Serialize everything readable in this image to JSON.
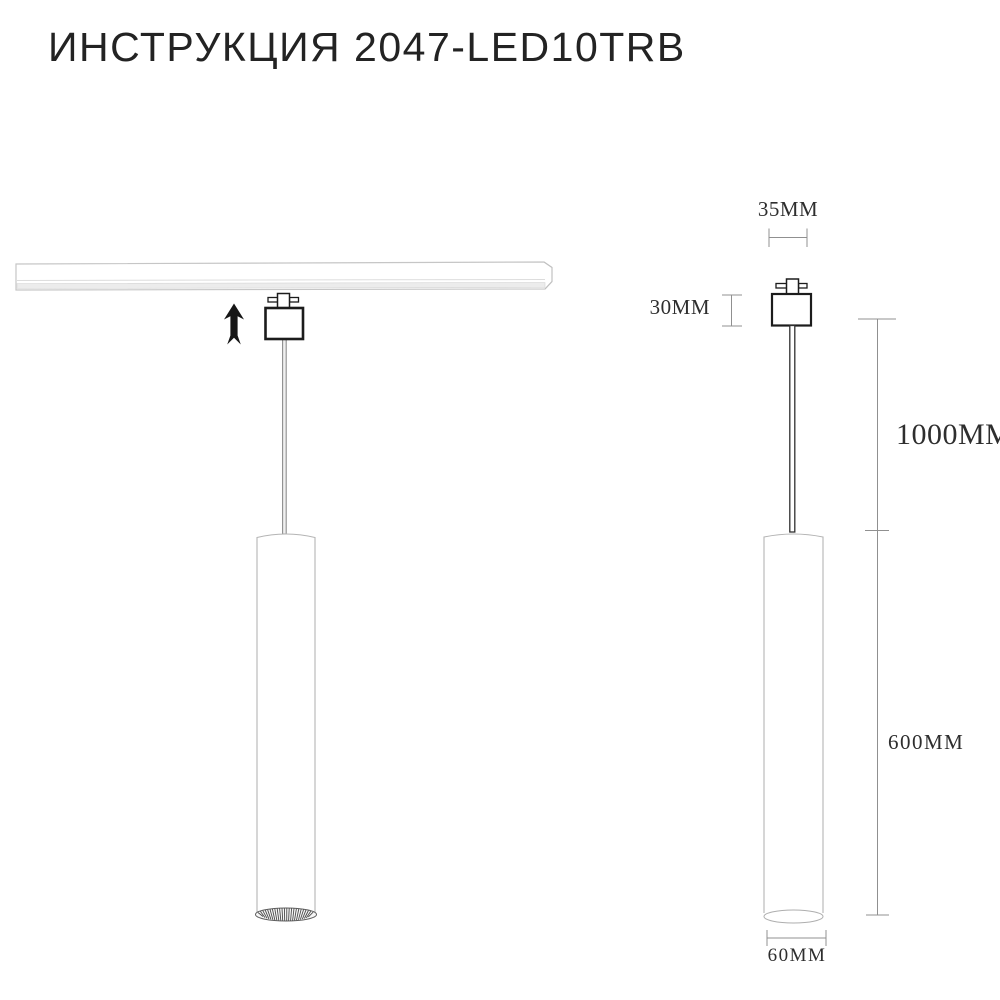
{
  "page": {
    "title": "ИНСТРУКЦИЯ 2047-LED10TRB",
    "background": "#ffffff"
  },
  "labels": {
    "adapter_width": "35MM",
    "adapter_height": "30MM",
    "suspension_length": "1000MM",
    "body_length": "600MM",
    "body_diameter": "60MM"
  },
  "icons": {
    "mount_direction": "arrow-up-icon"
  },
  "colors": {
    "ink_dark": "#1c1c1c",
    "outline_light": "#b4b4b4",
    "dimension_line": "#909090",
    "track_outline": "#c6c6c6",
    "text": "#2e2e2e"
  }
}
